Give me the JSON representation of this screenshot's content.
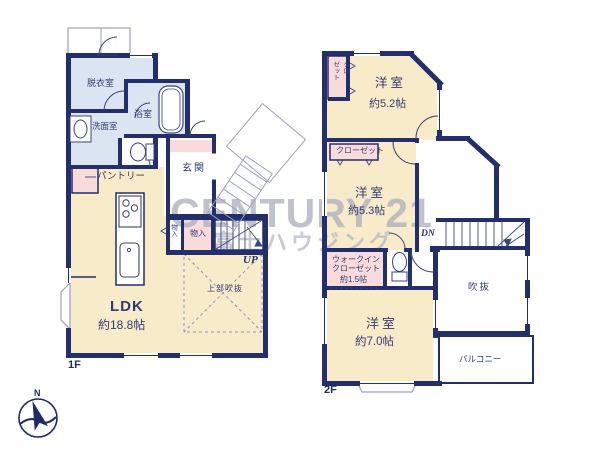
{
  "colors": {
    "wall": "#222f6b",
    "room_cream": "#f8ebc9",
    "room_blue": "#dbe5f2",
    "room_pink": "#f9dbdc",
    "watermark_gray": "#aeb1be"
  },
  "watermark": {
    "brand": "CENTURY 21",
    "company": "富士ハウジング"
  },
  "compass": {
    "north": "N"
  },
  "floor1": {
    "label": "1F",
    "stairs_label": "UP",
    "rooms": {
      "dressing": "脱衣室",
      "bath": "浴室",
      "washroom": "洗面室",
      "pantry": "パントリー",
      "entrance": "玄関",
      "storage_a": "物入",
      "storage_b": "物入",
      "ldk": "LDK",
      "ldk_size": "約18.8帖",
      "void_above": "上部吹抜"
    }
  },
  "floor2": {
    "label": "2F",
    "stairs_label": "DN",
    "rooms": {
      "closet_a": "クロー\nゼット",
      "bedroom_a": "洋室",
      "bedroom_a_size": "約5.2帖",
      "closet_b": "クローゼット",
      "bedroom_b": "洋室",
      "bedroom_b_size": "約5.3帖",
      "wic_line1": "ウォークイン",
      "wic_line2": "クローゼット",
      "wic_size": "約1.5帖",
      "bedroom_c": "洋室",
      "bedroom_c_size": "約7.0帖",
      "void": "吹抜",
      "balcony": "バルコニー"
    }
  }
}
